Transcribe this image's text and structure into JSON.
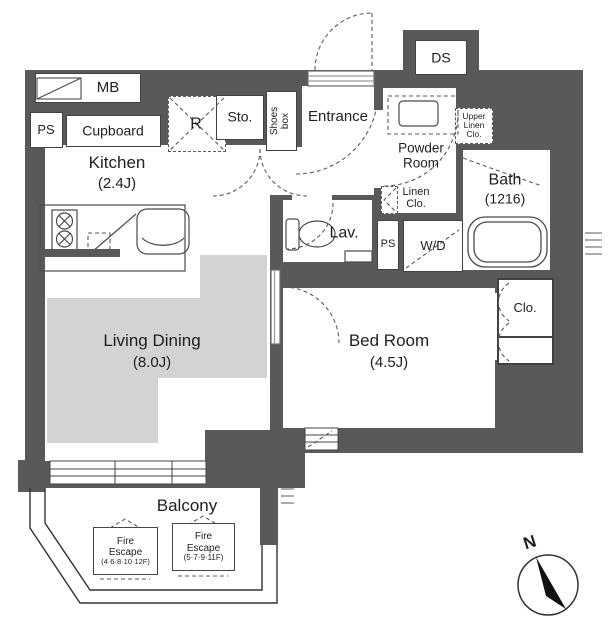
{
  "colors": {
    "wall": "#58595B",
    "floor_shade": "#D3D3D3",
    "line": "#3A3A3A"
  },
  "rooms": {
    "kitchen": {
      "name": "Kitchen",
      "size": "(2.4J)"
    },
    "living_dining": {
      "name": "Living Dining",
      "size": "(8.0J)"
    },
    "bed_room": {
      "name": "Bed Room",
      "size": "(4.5J)"
    },
    "bath": {
      "name": "Bath",
      "size": "(1216)"
    },
    "powder_room": {
      "line1": "Powder",
      "line2": "Room"
    },
    "entrance": {
      "name": "Entrance"
    },
    "lavatory": {
      "name": "Lav."
    },
    "balcony": {
      "name": "Balcony"
    }
  },
  "storage": {
    "mb": "MB",
    "ps_top": "PS",
    "cupboard": "Cupboard",
    "refrigerator": "R",
    "storage_closet": "Sto.",
    "shoes_box": {
      "line1": "Shoes",
      "line2": "box"
    },
    "ds": "DS",
    "upper_linen": {
      "line1": "Upper",
      "line2": "Linen",
      "line3": "Clo."
    },
    "linen": {
      "line1": "Linen",
      "line2": "Clo."
    },
    "ps_mid": "PS",
    "washer_dryer": "W/D",
    "closet": "Clo."
  },
  "balcony_features": {
    "fire_escape_1": {
      "line1": "Fire",
      "line2": "Escape",
      "line3": "(4·6·8·10·12F)"
    },
    "fire_escape_2": {
      "line1": "Fire",
      "line2": "Escape",
      "line3": "(5·7·9·11F)"
    }
  },
  "compass": {
    "north": "N"
  }
}
